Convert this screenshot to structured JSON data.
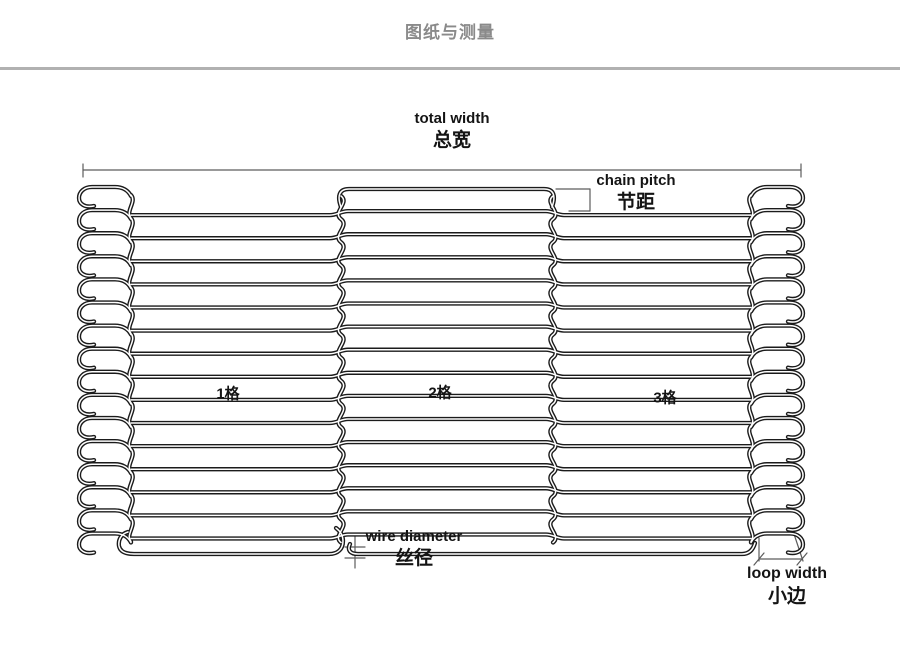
{
  "page": {
    "title": "图纸与测量"
  },
  "diagram": {
    "total_width": {
      "en": "total width",
      "zh": "总宽"
    },
    "chain_pitch": {
      "en": "chain pitch",
      "zh": "节距"
    },
    "wire_diameter": {
      "en": "wire diameter",
      "zh": "丝径"
    },
    "loop_width": {
      "en": "loop width",
      "zh": "小边"
    },
    "sections": [
      {
        "label": "1格"
      },
      {
        "label": "2格"
      },
      {
        "label": "3格"
      }
    ],
    "colors": {
      "wire": "#1b1b1b",
      "wire_core": "#ffffff",
      "dimension_line": "#5c5c5c",
      "label_text": "#141414",
      "title_text": "#8a8a8a",
      "divider": "#b1b1b1",
      "background": "#ffffff"
    }
  }
}
